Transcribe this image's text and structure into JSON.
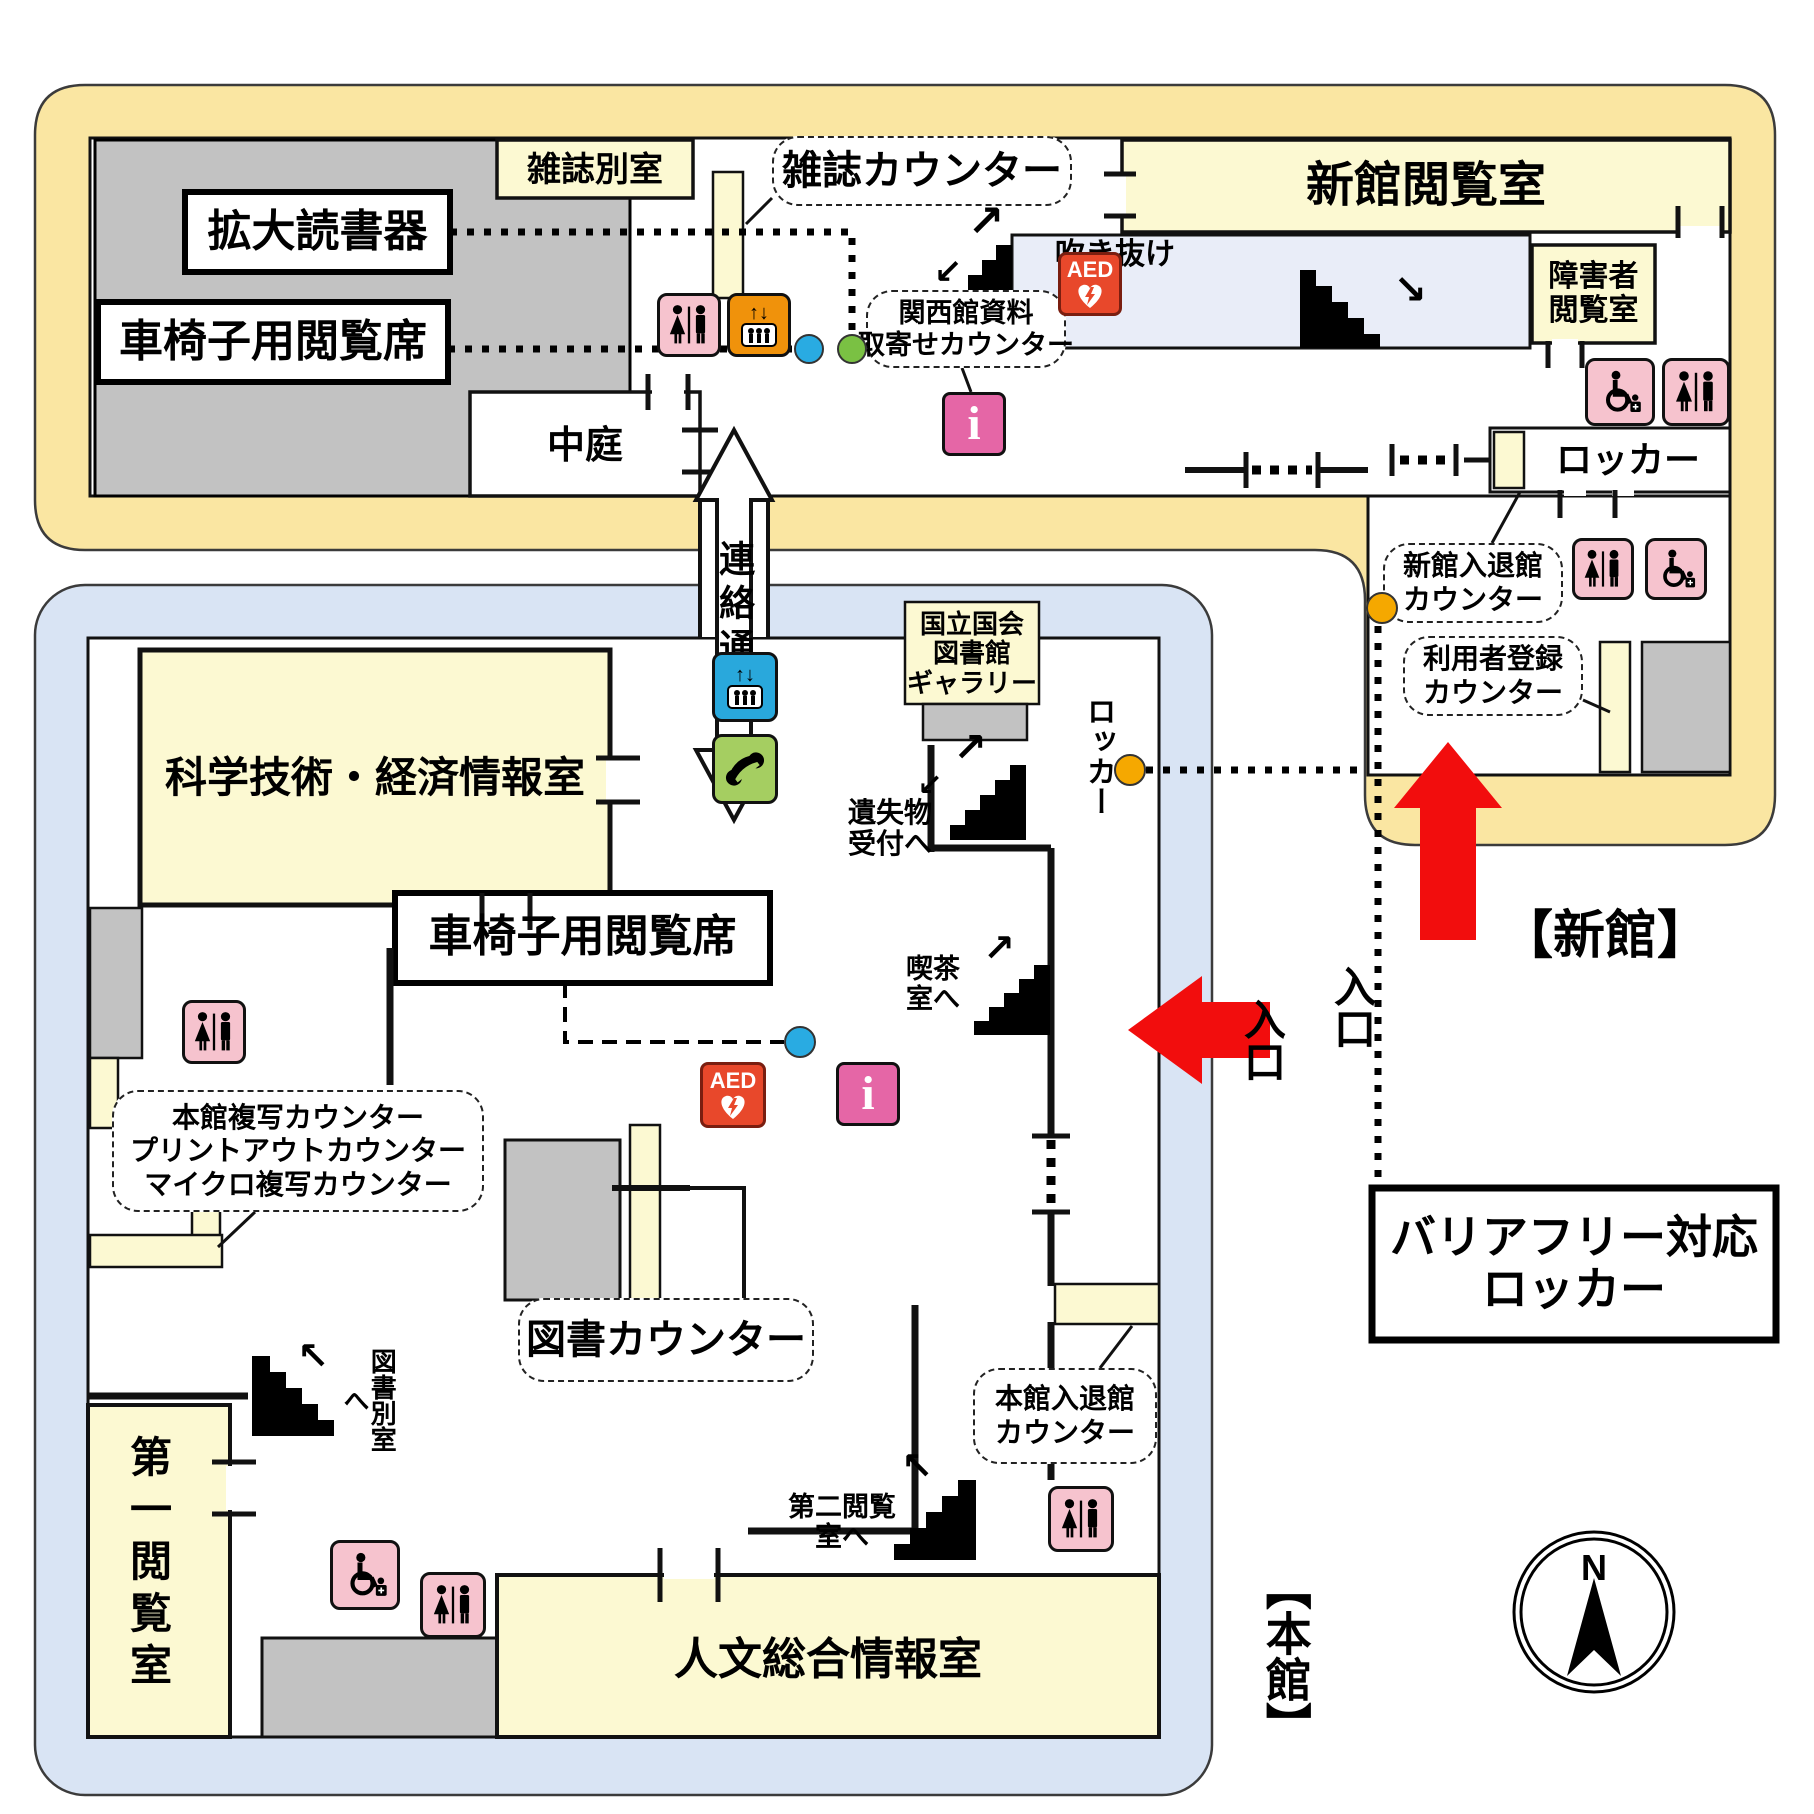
{
  "building_tags": {
    "shinkan": "【新館】",
    "honkan": "【本館】"
  },
  "rooms": {
    "zasshi_besshitsu": "雑誌別室",
    "shinkan_etsuranshitsu": "新館閲覧室",
    "fukinuke": "吹き抜け",
    "shogaisha_line1": "障害者",
    "shogaisha_line2": "閲覧室",
    "nakaniwa": "中庭",
    "locker_shinkan": "ロッカー",
    "kagaku_keizai": "科学技術・経済情報室",
    "gallery_line1": "国立国会",
    "gallery_line2": "図書館",
    "gallery_line3": "ギャラリー",
    "locker_honkan": "ロッカー",
    "daiichi_etsuranshitsu": "第一閲覧室",
    "jinbun_sogo": "人文総合情報室"
  },
  "feature_boxes": {
    "kakudai_dokushoki": "拡大読書器",
    "kurumaisu_shinkan": "車椅子用閲覧席",
    "kurumaisu_honkan": "車椅子用閲覧席",
    "barrier_free_line1": "バリアフリー対応",
    "barrier_free_line2": "ロッカー"
  },
  "corridor": {
    "renraku_tsuro": "連絡通路"
  },
  "callouts": {
    "zasshi_counter": "雑誌カウンター",
    "kansaikan_line1": "関西館資料",
    "kansaikan_line2": "取寄せカウンター",
    "shinkan_entry_line1": "新館入退館",
    "shinkan_entry_line2": "カウンター",
    "riyosha_line1": "利用者登録",
    "riyosha_line2": "カウンター",
    "fukusha_line1": "本館複写カウンター",
    "fukusha_line2": "プリントアウトカウンター",
    "fukusha_line3": "マイクロ複写カウンター",
    "tosho_counter": "図書カウンター",
    "honkan_entry_line1": "本館入退館",
    "honkan_entry_line2": "カウンター"
  },
  "directions": {
    "ishitsubutsu_line1": "遺失物",
    "ishitsubutsu_line2": "受付へ",
    "kissa_line1": "喫茶",
    "kissa_line2": "室へ",
    "daini_line1": "第二閲覧",
    "daini_line2": "室へ",
    "tosho_besshitsu": "図書別室へ",
    "entrance_shinkan": "入口",
    "entrance_honkan": "入口"
  },
  "icons": {
    "aed_label": "AED",
    "info_label": "i",
    "compass_north": "N",
    "elevator_arrows": "↑↓",
    "arrow_up_right": "↗",
    "arrow_down_left": "↙",
    "arrow_down_right": "↘",
    "arrow_up_left": "↖"
  },
  "colors": {
    "shinkan_band": "#FAE6A2",
    "honkan_band": "#D9E4F4",
    "room_yellow": "#FCF9D2",
    "atrium_blue": "#E9EDF8",
    "gray_area": "#C2C2C2",
    "icon_pink": "#F6C3CE",
    "elevator_orange": "#F0920B",
    "elevator_blue": "#29A8DC",
    "phone_green": "#A5CE61",
    "aed_red": "#E8482B",
    "info_pink": "#E566A6",
    "arrow_red": "#F20D0D",
    "dot_blue": "#29ABE2",
    "dot_green": "#7AC143",
    "dot_orange": "#F5A800"
  }
}
